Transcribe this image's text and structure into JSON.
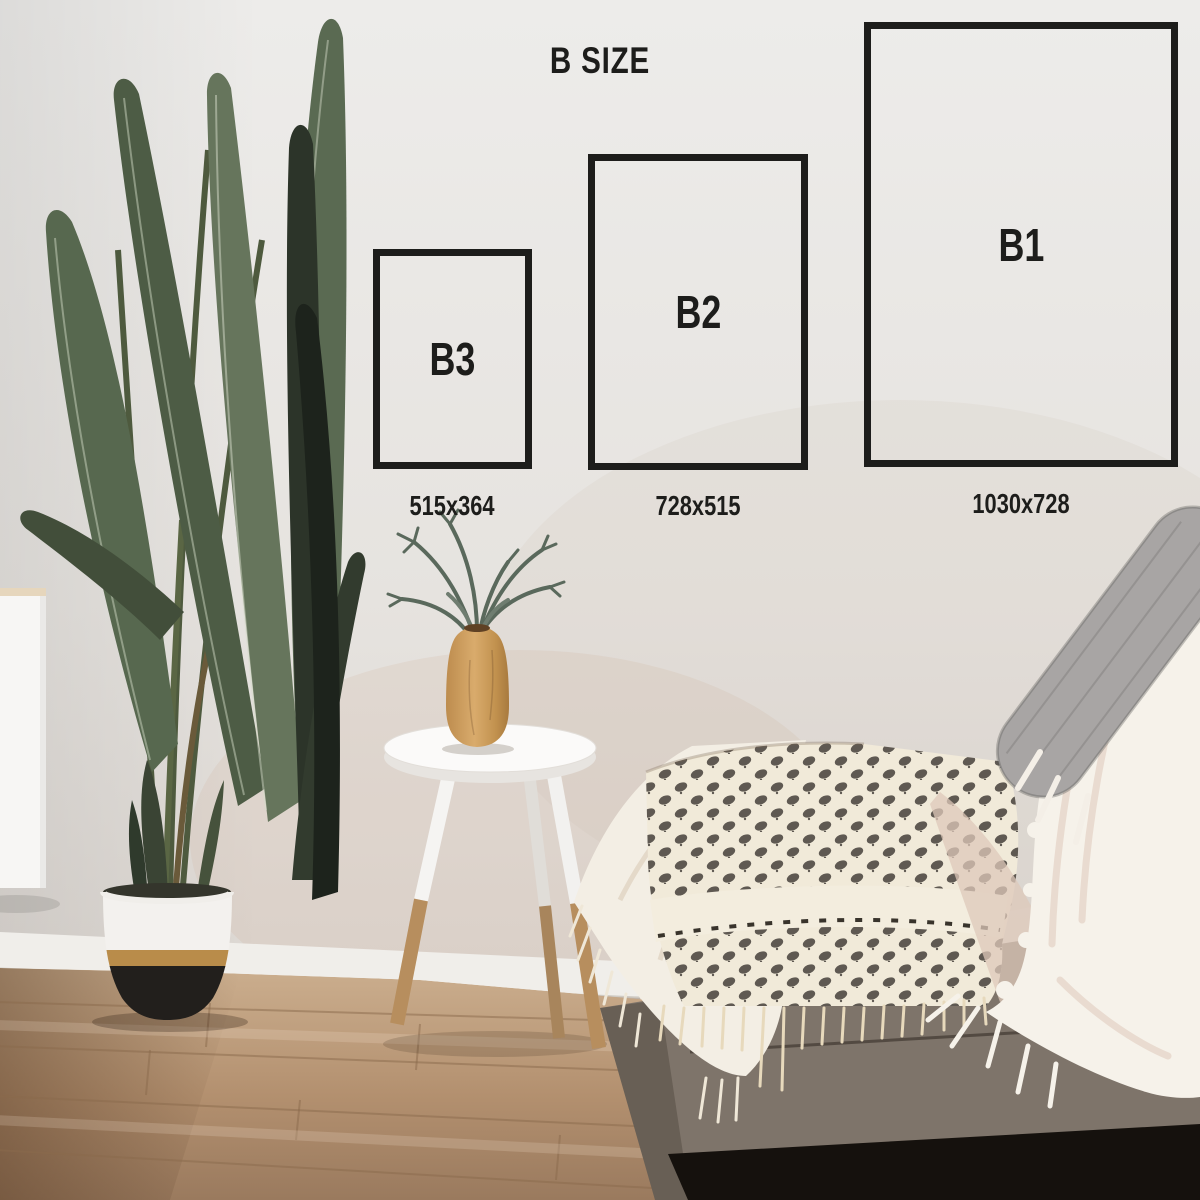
{
  "title": "B SIZE",
  "sizes": [
    {
      "label": "B3",
      "dimensions": "515x364"
    },
    {
      "label": "B2",
      "dimensions": "728x515"
    },
    {
      "label": "B1",
      "dimensions": "1030x728"
    }
  ],
  "colors": {
    "outline": "#1d1d1b",
    "label_text": "#1d1d1b",
    "wall": "#e6e3df",
    "floor_wood": "#b3906f",
    "pot_gold_band": "#b98c4a",
    "plant_leaf_green": "#5a6a52",
    "couch_gray": "#7e746a",
    "throw_cream": "#f1ead9"
  }
}
